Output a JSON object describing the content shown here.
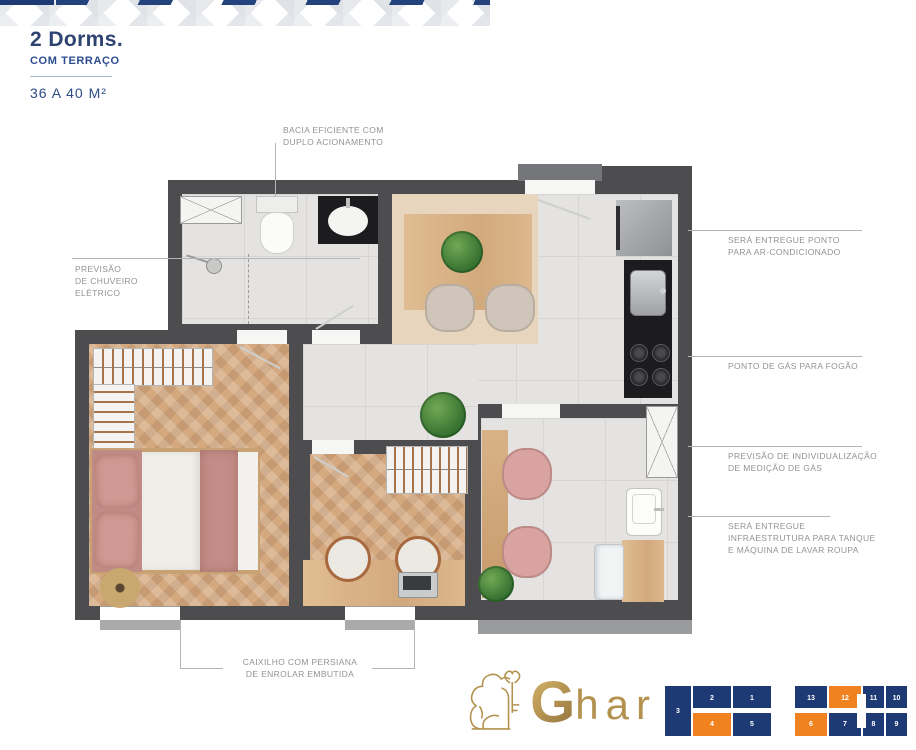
{
  "header": {
    "title": "2 Dorms.",
    "subtitle": "COM TERRAÇO",
    "area": "36 A 40 M²"
  },
  "annotations": {
    "bacia": {
      "lines": [
        "BACIA EFICIENTE COM",
        "DUPLO ACIONAMENTO"
      ]
    },
    "chuveiro": {
      "lines": [
        "PREVISÃO",
        "DE  CHUVEIRO",
        "ELÉTRICO"
      ]
    },
    "ar_condicionado": {
      "lines": [
        "SERÁ ENTREGUE PONTO",
        "PARA AR-CONDICIONADO"
      ]
    },
    "gas_fogao": {
      "lines": [
        "PONTO DE GÁS PARA FOGÃO"
      ]
    },
    "medicao_gas": {
      "lines": [
        "PREVISÃO DE INDIVIDUALIZAÇÃO",
        "DE MEDIÇÃO DE GÁS"
      ]
    },
    "tanque": {
      "lines": [
        "SERÁ ENTREGUE",
        "INFRAESTRUTURA PARA TANQUE",
        "E MÁQUINA DE LAVAR ROUPA"
      ]
    },
    "caixilho": {
      "lines": [
        "CAIXILHO COM PERSIANA",
        "DE ENROLAR EMBUTIDA"
      ]
    }
  },
  "logo": {
    "brand": "Ghar",
    "g": "G",
    "rest": "har",
    "gold": "#b3924f",
    "lion_icon": "lion-with-key"
  },
  "keyplan": {
    "navy": "#1d3a75",
    "orange": "#f0821f",
    "units": [
      {
        "label": "3",
        "hex": "#1d3a75"
      },
      {
        "label": "2",
        "hex": "#1d3a75"
      },
      {
        "label": "1",
        "hex": "#1d3a75"
      },
      {
        "label": "13",
        "hex": "#1d3a75"
      },
      {
        "label": "12",
        "hex": "#f0821f"
      },
      {
        "label": "11",
        "hex": "#1d3a75"
      },
      {
        "label": "10",
        "hex": "#1d3a75"
      },
      {
        "label": "4",
        "hex": "#f0821f"
      },
      {
        "label": "5",
        "hex": "#1d3a75"
      },
      {
        "label": "6",
        "hex": "#f0821f"
      },
      {
        "label": "7",
        "hex": "#1d3a75"
      },
      {
        "label": "8",
        "hex": "#1d3a75"
      },
      {
        "label": "9",
        "hex": "#1d3a75"
      }
    ]
  }
}
